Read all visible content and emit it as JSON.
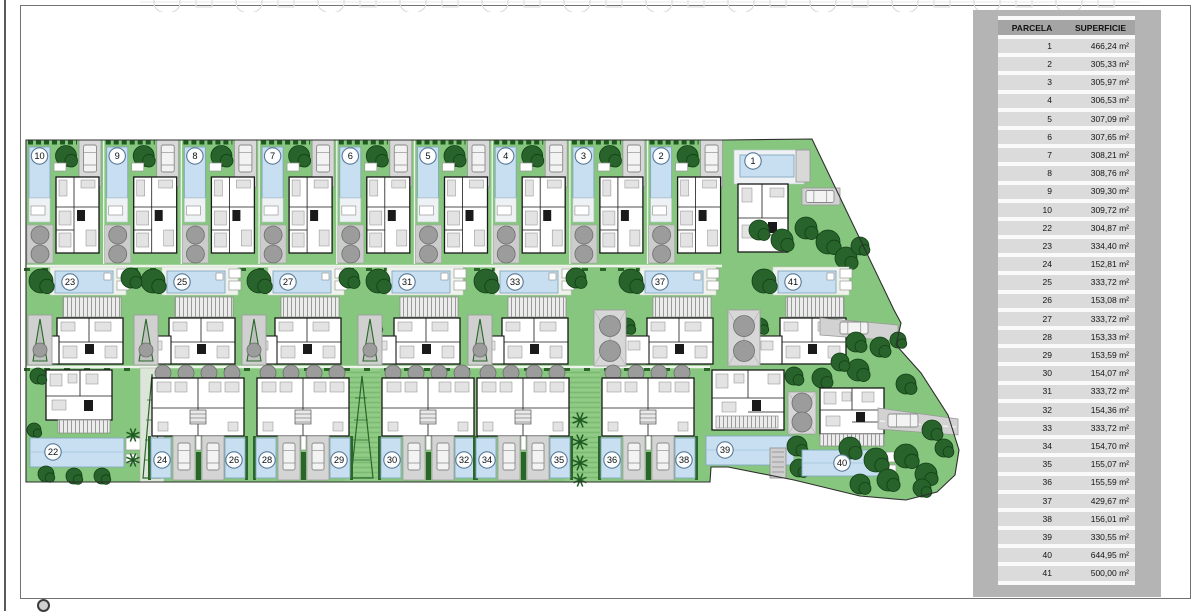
{
  "site_plan": {
    "row1_villas": [
      "10",
      "9",
      "8",
      "7",
      "6",
      "5",
      "4",
      "3",
      "2"
    ],
    "plot1": "1",
    "row2_villas": [
      "23",
      "25",
      "27",
      "31",
      "33",
      "37",
      "41"
    ],
    "plot22": "22",
    "townhouse_blocks": [
      [
        "24",
        "26"
      ],
      [
        "28",
        "29"
      ],
      [
        "30",
        "32"
      ],
      [
        "34",
        "35"
      ],
      [
        "36",
        "38"
      ]
    ],
    "plot39": "39",
    "plot40": "40"
  },
  "legend_table": {
    "headers": [
      "PARCELA",
      "SUPERFICIE"
    ],
    "rows": [
      [
        "1",
        "466,24 m²"
      ],
      [
        "2",
        "305,33 m²"
      ],
      [
        "3",
        "305,97 m²"
      ],
      [
        "4",
        "306,53 m²"
      ],
      [
        "5",
        "307,09 m²"
      ],
      [
        "6",
        "307,65 m²"
      ],
      [
        "7",
        "308,21 m²"
      ],
      [
        "8",
        "308,76 m²"
      ],
      [
        "9",
        "309,30 m²"
      ],
      [
        "10",
        "309,72 m²"
      ],
      [
        "22",
        "304,87 m²"
      ],
      [
        "23",
        "334,40 m²"
      ],
      [
        "24",
        "152,81 m²"
      ],
      [
        "25",
        "333,72 m²"
      ],
      [
        "26",
        "153,08 m²"
      ],
      [
        "27",
        "333,72 m²"
      ],
      [
        "28",
        "153,33 m²"
      ],
      [
        "29",
        "153,59 m²"
      ],
      [
        "30",
        "154,07 m²"
      ],
      [
        "31",
        "333,72 m²"
      ],
      [
        "32",
        "154,36 m²"
      ],
      [
        "33",
        "333,72 m²"
      ],
      [
        "34",
        "154,70 m²"
      ],
      [
        "35",
        "155,07 m²"
      ],
      [
        "36",
        "155,59 m²"
      ],
      [
        "37",
        "429,67 m²"
      ],
      [
        "38",
        "156,01 m²"
      ],
      [
        "39",
        "330,55 m²"
      ],
      [
        "40",
        "644,95 m²"
      ],
      [
        "41",
        "500,00 m²"
      ]
    ]
  },
  "colors": {
    "grass": "#87c67e",
    "stripe_green": "#90cc86",
    "tree_dark": "#27632a",
    "pool_blue": "#c7dff0",
    "pool_edge": "#84a7bf",
    "road_gray": "#d2d2d2",
    "shrub_gray": "#9c9c9c",
    "panel_gray": "#b4b4b4",
    "boundary": "#2e2e2e",
    "number_ring": "#5a7895"
  }
}
